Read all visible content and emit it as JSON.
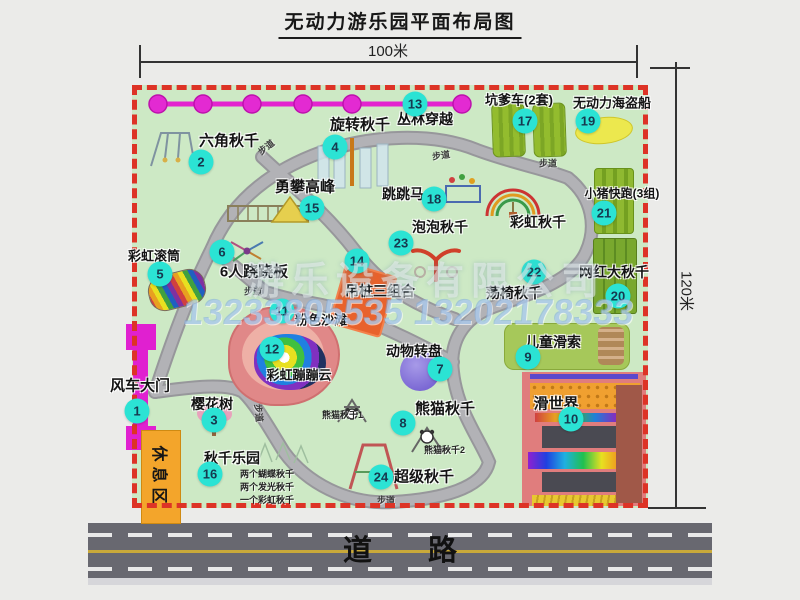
{
  "title": "无动力游乐园平面布局图",
  "dimensions": {
    "top": "100米",
    "right": "120米"
  },
  "road": {
    "label": "道路"
  },
  "walkway_label": "步道",
  "rest_area_label": "休息区",
  "watermark": {
    "company": "游乐设备有限公司",
    "phones": "13233805535 13202178333"
  },
  "legend_extra": {
    "rainbow_swing": "彩虹秋千"
  },
  "attractions": [
    {
      "num": "1",
      "name": "风车大门"
    },
    {
      "num": "2",
      "name": "六角秋千"
    },
    {
      "num": "3",
      "name": "樱花树"
    },
    {
      "num": "4",
      "name": "旋转秋千"
    },
    {
      "num": "5",
      "name": "彩虹滚筒"
    },
    {
      "num": "6",
      "name": "6人跷跷板"
    },
    {
      "num": "7",
      "name": "动物转盘"
    },
    {
      "num": "8",
      "name": "熊猫秋千",
      "sub1": "熊猫秋千1",
      "sub2": "熊猫秋千2"
    },
    {
      "num": "9",
      "name": "儿童滑索"
    },
    {
      "num": "10",
      "name": "滑世界"
    },
    {
      "num": "11",
      "name": "粉色沙滩"
    },
    {
      "num": "12",
      "name": "彩虹蹦蹦云"
    },
    {
      "num": "13",
      "name": "丛林穿越"
    },
    {
      "num": "14",
      "name": "吊桩三组合"
    },
    {
      "num": "15",
      "name": "勇攀高峰"
    },
    {
      "num": "16",
      "name": "秋千乐园",
      "notes": [
        "两个蝴蝶秋千",
        "两个发光秋千",
        "一个彩虹秋千"
      ]
    },
    {
      "num": "17",
      "name": "坑爹车(2套)"
    },
    {
      "num": "18",
      "name": "跳跳马"
    },
    {
      "num": "19",
      "name": "无动力海盗船"
    },
    {
      "num": "20",
      "name": "网红大秋千"
    },
    {
      "num": "21",
      "name": "小猪快跑(3组)"
    },
    {
      "num": "22",
      "name": "荡椅秋千"
    },
    {
      "num": "23",
      "name": "泡泡秋千"
    },
    {
      "num": "24",
      "name": "超级秋千"
    }
  ],
  "colors": {
    "border_red": "#dd3326",
    "badge_cyan": "#2be3d4",
    "magenta": "#e020d0",
    "map_green": "#cde9c5",
    "road_gray": "#686870",
    "rest_orange": "#f3a52b",
    "facility_green": "#8fb931",
    "pirate_yellow": "#ece84e",
    "slideworld_pink": "#e07d7d"
  }
}
